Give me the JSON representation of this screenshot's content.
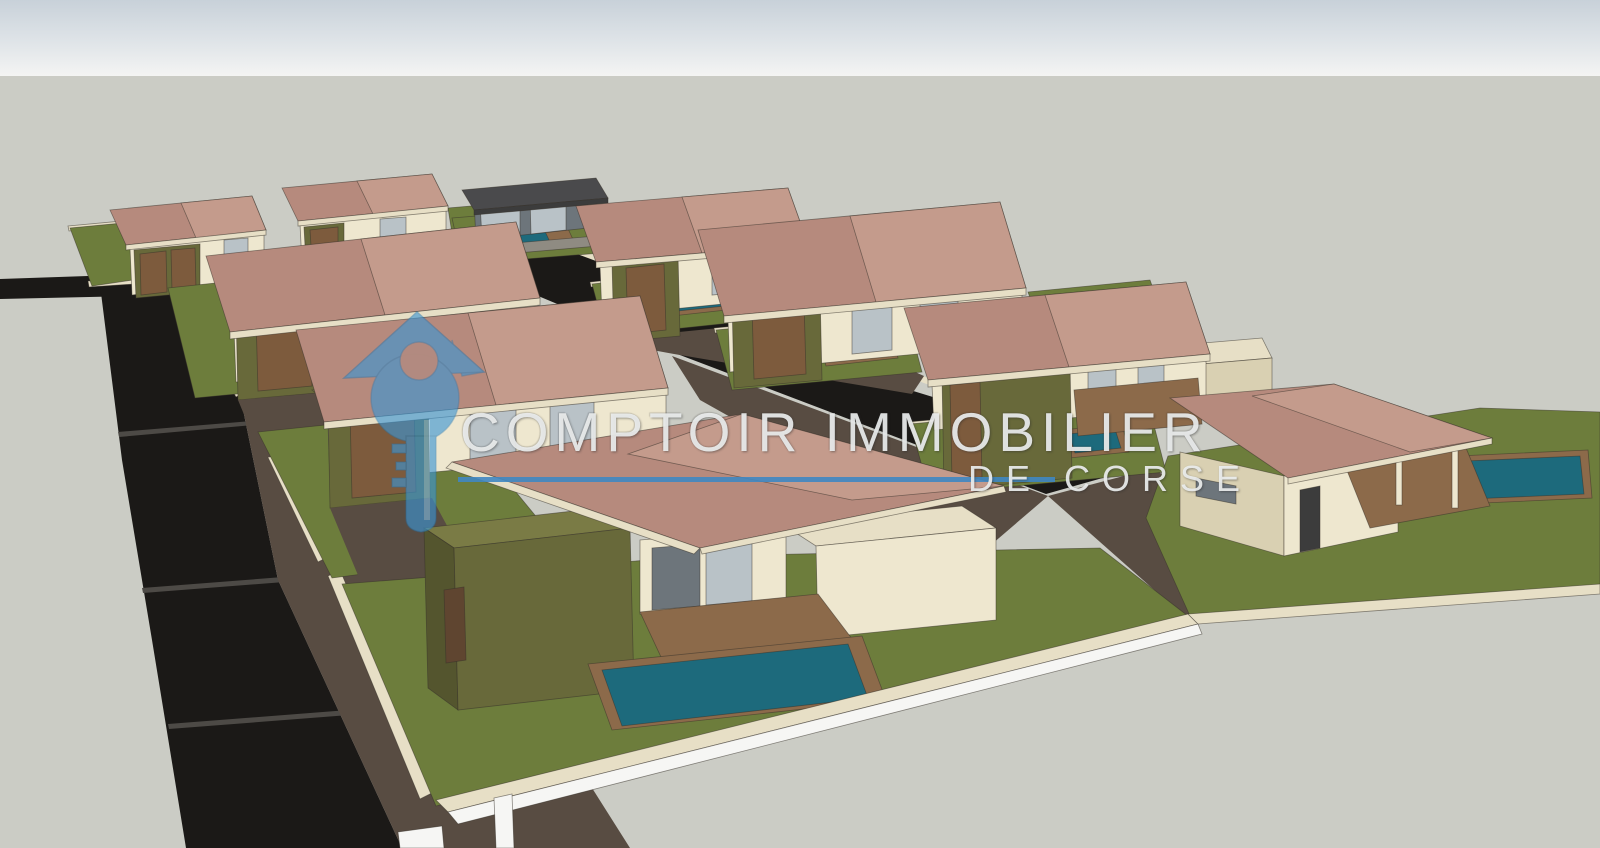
{
  "watermark": {
    "title": "COMPTOIR IMMOBILIER",
    "subtitle": "DE CORSE",
    "logo_color": "#3b96d5",
    "logo_edge_color": "#1f6fa8",
    "line_color": "#3f87c2",
    "text_color": "#e9ecec"
  },
  "palette": {
    "sky_top": "#c8d1d9",
    "sky_mid": "#dfe4e8",
    "sky_bottom": "#f4f4f3",
    "ground": "#cbccc5",
    "road": "#1b1917",
    "road_seam": "#4d4a46",
    "drive": "#584c42",
    "drive_dark": "#453c34",
    "lawn": "#6d7d3c",
    "roof": "#b68a7d",
    "roof_light": "#c49b8c",
    "dark_roof": "#4a4a4c",
    "eave": "#e7dfc6",
    "wall_light": "#eee7cf",
    "wall_mid": "#d9d0b2",
    "wall_dark": "#c4b998",
    "olive": "#68693a",
    "olive_top": "#7a7b45",
    "olive_dark": "#54552e",
    "wood": "#7d5b3d",
    "wood_dark": "#5f4530",
    "deck": "#8c6a4a",
    "pool": "#1d6a7c",
    "glass": "#b9c2c7",
    "glass_dark": "#6d757b",
    "frame": "#3c3c3c",
    "stone": "#8f8b82",
    "white": "#f6f6f4"
  },
  "scene": {
    "description": "SketchUp-style 3D render of a villa development: two rows of hip-roof villas with olive garages, lawns, pools, paved driveways and dark asphalt roads, viewed from above.",
    "polygons": [
      {
        "n": "road-stub-left",
        "f": "road",
        "s": "none",
        "p": "0,279 178,273 178,295 0,299"
      },
      {
        "n": "main-road",
        "f": "road",
        "s": "none",
        "p": "100,285 180,279 232,356 278,580 402,848 186,848 152,640 122,460"
      },
      {
        "n": "road-seam-1",
        "f": "road_seam",
        "s": "none",
        "p": "118,432 264,420 265,424 119,437"
      },
      {
        "n": "road-seam-2",
        "f": "road_seam",
        "s": "none",
        "p": "142,588 322,574 323,579 143,593"
      },
      {
        "n": "road-seam-3",
        "f": "road_seam",
        "s": "none",
        "p": "168,724 374,708 375,713 169,729"
      },
      {
        "n": "central-street",
        "f": "road",
        "s": "none",
        "p": "438,254 566,246 910,390 1152,464 1046,494 672,352"
      },
      {
        "n": "street-curb",
        "f": "eave",
        "s": "none",
        "p": "564,243 1150,460 1147,466 561,248"
      },
      {
        "n": "drive-band-left",
        "f": "drive",
        "s": "none",
        "p": "180,279 252,300 344,424 436,564 530,690 630,848 402,848 278,580 232,356"
      },
      {
        "n": "drive-patch-1",
        "f": "drive_dark",
        "s": "none",
        "p": "262,352 330,344 372,418 300,428"
      },
      {
        "n": "drive-patch-2",
        "f": "drive_dark",
        "s": "none",
        "p": "330,470 420,458 470,540 376,552"
      },
      {
        "n": "drive-street-top",
        "f": "drive",
        "s": "none",
        "p": "598,340 800,320 924,376 912,394 674,354"
      },
      {
        "n": "drive-street-bottom",
        "f": "drive",
        "s": "none",
        "p": "672,356 1048,496 978,556 700,400"
      },
      {
        "n": "drive-access-right",
        "f": "drive",
        "s": "none",
        "p": "1048,496 1154,468 1278,566 1186,618"
      },
      {
        "n": "wall-cap-1",
        "f": "eave",
        "p": "88,281 178,275 179,281 89,287"
      },
      {
        "n": "wall-cap-2",
        "f": "eave",
        "p": "172,290 180,286 246,392 236,397"
      },
      {
        "n": "wall-cap-3",
        "f": "eave",
        "p": "250,420 260,415 330,556 318,562"
      },
      {
        "n": "wall-cap-4",
        "f": "eave",
        "p": "328,576 340,570 434,792 420,799"
      },
      {
        "n": "villa1-lawn-cap",
        "f": "eave",
        "p": "68,226 240,210 241,215 69,231"
      },
      {
        "n": "villa1-lawn",
        "f": "lawn",
        "p": "70,228 240,212 254,262 92,286"
      },
      {
        "n": "villa1-driveway",
        "f": "drive",
        "s": "none",
        "p": "254,262 318,256 342,300 266,308"
      },
      {
        "n": "villa1-wall",
        "f": "wall_light",
        "p": "130,248 264,234 264,280 132,295"
      },
      {
        "n": "villa1-window",
        "f": "glass",
        "p": "224,240 248,238 248,262 224,264"
      },
      {
        "n": "villa1-garage",
        "f": "olive",
        "p": "134,250 200,244 200,292 136,298"
      },
      {
        "n": "villa1-garage-door-1",
        "f": "wood",
        "p": "140,254 166,251 167,292 141,295"
      },
      {
        "n": "villa1-garage-door-2",
        "f": "wood",
        "p": "171,250 195,248 196,289 172,291"
      },
      {
        "n": "villa1-roof",
        "f": "roof",
        "p": "110,210 252,196 266,230 126,245"
      },
      {
        "n": "villa1-roof-hip",
        "f": "roof_light",
        "p": "181,203 252,196 266,230 196,238"
      },
      {
        "n": "villa1-fascia",
        "f": "eave",
        "p": "126,245 266,230 266,235 126,250"
      },
      {
        "n": "villa2-wall",
        "f": "wall_light",
        "p": "300,224 446,210 446,250 302,264"
      },
      {
        "n": "villa2-garage",
        "f": "olive",
        "p": "304,227 344,223 344,260 306,264"
      },
      {
        "n": "villa2-garage-door",
        "f": "wood",
        "p": "310,230 338,227 338,258 312,261"
      },
      {
        "n": "villa2-window",
        "f": "glass",
        "p": "380,219 406,217 406,242 380,244"
      },
      {
        "n": "villa2-lawn",
        "f": "lawn",
        "p": "448,208 506,203 518,240 454,246"
      },
      {
        "n": "villa2-roof",
        "f": "roof",
        "p": "282,188 432,174 448,206 298,221"
      },
      {
        "n": "villa2-roof-hip",
        "f": "roof_light",
        "p": "357,181 432,174 448,206 373,214"
      },
      {
        "n": "villa2-fascia",
        "f": "eave",
        "p": "298,221 448,206 448,211 298,226"
      },
      {
        "n": "modern-house-lawn",
        "f": "lawn",
        "p": "452,218 600,206 614,252 462,264"
      },
      {
        "n": "modern-house-deck",
        "f": "deck",
        "p": "470,228 564,220 576,246 480,254"
      },
      {
        "n": "modern-house-pool",
        "f": "pool",
        "p": "488,230 542,225 550,242 494,247"
      },
      {
        "n": "modern-house-body",
        "f": "glass_dark",
        "p": "474,200 588,190 588,228 476,240"
      },
      {
        "n": "modern-house-glass-1",
        "f": "glass",
        "p": "480,203 520,200 520,234 482,238"
      },
      {
        "n": "modern-house-glass-2",
        "f": "glass",
        "p": "530,198 566,195 566,230 531,234"
      },
      {
        "n": "modern-house-flat-roof",
        "f": "dark_roof",
        "p": "462,190 596,178 608,198 474,210"
      },
      {
        "n": "modern-house-roof-edge",
        "f": "frame",
        "p": "474,210 608,198 608,203 474,215"
      },
      {
        "n": "modern-house-front-wall",
        "f": "stone",
        "p": "458,248 596,236 598,246 460,258"
      },
      {
        "n": "villa4-lawn-cap",
        "f": "eave",
        "p": "590,282 784,262 785,267 591,287"
      },
      {
        "n": "villa4-lawn",
        "f": "lawn",
        "p": "592,284 784,264 798,316 606,336"
      },
      {
        "n": "villa4-pool-deck",
        "f": "deck",
        "p": "664,290 736,282 744,308 672,316"
      },
      {
        "n": "villa4-pool",
        "f": "pool",
        "p": "672,294 728,288 734,305 678,311"
      },
      {
        "n": "villa4-wall",
        "f": "wall_light",
        "p": "600,266 804,248 804,296 602,316"
      },
      {
        "n": "villa4-window-1",
        "f": "glass",
        "p": "712,256 744,253 744,292 712,295"
      },
      {
        "n": "villa4-window-2",
        "f": "glass",
        "p": "760,252 790,250 790,288 760,291"
      },
      {
        "n": "villa4-garage-top",
        "f": "olive_top",
        "p": "598,252 664,246 678,256 612,262"
      },
      {
        "n": "villa4-garage",
        "f": "olive",
        "p": "612,262 678,256 680,336 614,342"
      },
      {
        "n": "villa4-garage-door",
        "f": "wood",
        "p": "626,268 664,264 666,330 628,334"
      },
      {
        "n": "villa4-roof",
        "f": "roof",
        "p": "576,206 788,188 808,244 596,262"
      },
      {
        "n": "villa4-roof-hip",
        "f": "roof_light",
        "p": "682,197 788,188 808,244 702,253"
      },
      {
        "n": "villa4-fascia",
        "f": "eave",
        "p": "596,262 808,244 808,250 596,268"
      },
      {
        "n": "villa5-lawn-cap",
        "f": "eave",
        "p": "714,328 906,310 907,315 715,333"
      },
      {
        "n": "villa5-lawn",
        "f": "lawn",
        "p": "716,330 906,312 922,372 732,390"
      },
      {
        "n": "villa5-pool-deck",
        "f": "deck",
        "p": "818,336 890,328 898,358 826,366"
      },
      {
        "n": "villa5-pool",
        "f": "pool",
        "p": "826,340 882,334 889,355 833,361"
      },
      {
        "n": "villa5-terrace",
        "f": "deck",
        "p": "962,344 1022,338 1036,374 976,380"
      },
      {
        "n": "villa5-wall",
        "f": "wall_light",
        "p": "728,320 1022,292 1022,344 730,372"
      },
      {
        "n": "villa5-window-1",
        "f": "glass",
        "p": "852,308 892,304 892,350 852,354"
      },
      {
        "n": "villa5-window-2",
        "f": "glass",
        "p": "920,301 958,298 958,344 920,348"
      },
      {
        "n": "villa5-garage-top",
        "f": "olive_top",
        "p": "718,288 806,280 820,291 732,299"
      },
      {
        "n": "villa5-garage",
        "f": "olive",
        "p": "732,299 820,291 822,380 734,388"
      },
      {
        "n": "villa5-garage-door",
        "f": "wood",
        "p": "752,306 804,301 806,374 754,379"
      },
      {
        "n": "villa5-roof",
        "f": "roof",
        "p": "698,230 1000,202 1026,288 724,316"
      },
      {
        "n": "villa5-roof-hip",
        "f": "roof_light",
        "p": "850,216 1000,202 1026,288 876,302"
      },
      {
        "n": "villa5-fascia",
        "f": "eave",
        "p": "724,316 1026,288 1026,295 724,323"
      },
      {
        "n": "lawn-strip-right",
        "f": "lawn",
        "p": "1028,292 1150,280 1162,314 1040,326"
      },
      {
        "n": "villa6-lawn-cap",
        "f": "eave",
        "p": "908,422 1148,400 1149,405 909,427"
      },
      {
        "n": "villa6-lawn",
        "f": "lawn",
        "p": "910,424 1148,402 1166,472 930,494"
      },
      {
        "n": "villa6-pool-deck",
        "f": "deck",
        "p": "1062,430 1122,424 1129,452 1069,458"
      },
      {
        "n": "villa6-pool",
        "f": "pool",
        "p": "1069,434 1115,429 1121,448 1075,453"
      },
      {
        "n": "villa6-backbox-top",
        "f": "eave",
        "p": "1192,344 1262,338 1272,358 1202,364"
      },
      {
        "n": "villa6-backbox",
        "f": "wall_mid",
        "p": "1202,364 1272,358 1272,394 1202,400"
      },
      {
        "n": "villa6-wall",
        "f": "wall_light",
        "p": "932,384 1206,358 1206,406 934,430"
      },
      {
        "n": "villa6-window-1",
        "f": "glass",
        "p": "1088,368 1116,366 1116,400 1088,402"
      },
      {
        "n": "villa6-window-2",
        "f": "glass",
        "p": "1138,364 1164,362 1164,396 1138,398"
      },
      {
        "n": "villa6-terrace",
        "f": "deck",
        "p": "1074,390 1198,378 1202,424 1078,436"
      },
      {
        "n": "villa6-garage-top",
        "f": "olive_top",
        "p": "928,364 1056,352 1070,363 942,375"
      },
      {
        "n": "villa6-garage",
        "f": "olive",
        "p": "942,375 1070,363 1072,478 944,490"
      },
      {
        "n": "villa6-garage-door",
        "f": "wood",
        "p": "950,385 980,382 982,477 952,480"
      },
      {
        "n": "villa6-roof",
        "f": "roof",
        "p": "904,308 1186,282 1210,354 928,380"
      },
      {
        "n": "villa6-roof-hip",
        "f": "roof_light",
        "p": "1045,295 1186,282 1210,354 1069,367"
      },
      {
        "n": "villa6-fascia",
        "f": "eave",
        "p": "928,380 1210,354 1210,361 928,387"
      },
      {
        "n": "villa7-lawn",
        "f": "lawn",
        "p": "1168,456 1480,408 1600,412 1600,586 1190,616 1146,518"
      },
      {
        "n": "villa7-pool-deck",
        "f": "deck",
        "p": "1458,456 1588,450 1592,498 1462,504"
      },
      {
        "n": "villa7-pool",
        "f": "pool",
        "p": "1466,461 1580,456 1584,494 1470,499"
      },
      {
        "n": "villa7-side-wall",
        "f": "wall_mid",
        "p": "1180,452 1284,476 1284,556 1180,526"
      },
      {
        "n": "villa7-front-wall",
        "f": "wall_light",
        "p": "1284,476 1398,452 1398,532 1284,556"
      },
      {
        "n": "villa7-door",
        "f": "frame",
        "p": "1300,490 1320,486 1320,548 1300,552"
      },
      {
        "n": "villa7-window",
        "f": "glass_dark",
        "p": "1196,478 1236,486 1236,504 1196,496"
      },
      {
        "n": "villa7-porch-deck",
        "f": "deck",
        "p": "1346,468 1466,448 1490,506 1370,528"
      },
      {
        "n": "villa7-porch-post-1",
        "f": "wall_light",
        "p": "1396,448 1402,448 1402,505 1396,505"
      },
      {
        "n": "villa7-porch-post-2",
        "f": "wall_light",
        "p": "1452,444 1458,444 1458,508 1452,508"
      },
      {
        "n": "villa7-roof",
        "f": "roof",
        "p": "1170,398 1334,384 1492,438 1288,478"
      },
      {
        "n": "villa7-roof-hip",
        "f": "roof_light",
        "p": "1252,396 1334,384 1492,438 1410,452"
      },
      {
        "n": "villa7-fascia",
        "f": "eave",
        "p": "1288,478 1492,438 1492,444 1288,484"
      },
      {
        "n": "villa8-lawn",
        "f": "lawn",
        "p": "168,288 340,270 362,382 195,398"
      },
      {
        "n": "villa8-pool-deck",
        "f": "deck",
        "p": "270,338 340,331 348,362 278,369"
      },
      {
        "n": "villa8-pool",
        "f": "pool",
        "p": "278,342 332,337 339,358 285,363"
      },
      {
        "n": "villa8-wall",
        "f": "wall_light",
        "p": "234,330 538,302 538,354 236,382"
      },
      {
        "n": "villa8-window-1",
        "f": "glass",
        "p": "356,320 398,316 398,364 356,368"
      },
      {
        "n": "villa8-window-2",
        "f": "glass",
        "p": "430,313 470,309 470,358 430,362"
      },
      {
        "n": "villa8-garage-top",
        "f": "olive_top",
        "p": "222,298 312,290 326,301 236,309"
      },
      {
        "n": "villa8-garage",
        "f": "olive",
        "p": "236,309 326,301 328,392 238,400"
      },
      {
        "n": "villa8-garage-door",
        "f": "wood",
        "p": "256,316 310,311 312,386 258,391"
      },
      {
        "n": "villa8-driveway",
        "f": "drive",
        "s": "none",
        "p": "238,400 330,392 360,448 262,458"
      },
      {
        "n": "villa8-roof",
        "f": "roof",
        "p": "206,256 516,222 540,298 230,332"
      },
      {
        "n": "villa8-roof-hip",
        "f": "roof_light",
        "p": "361,239 516,222 540,298 385,315"
      },
      {
        "n": "villa8-fascia",
        "f": "eave",
        "p": "230,332 540,298 540,305 230,339"
      },
      {
        "n": "villa9-lawn",
        "f": "lawn",
        "p": "258,432 450,412 562,548 332,578"
      },
      {
        "n": "villa9-pool-deck",
        "f": "deck",
        "p": "440,534 546,522 558,556 452,568"
      },
      {
        "n": "villa9-pool",
        "f": "pool",
        "p": "448,539 538,528 548,553 458,564"
      },
      {
        "n": "villa9-wall",
        "f": "wall_light",
        "p": "328,424 666,392 666,450 330,482"
      },
      {
        "n": "villa9-window-1",
        "f": "glass",
        "p": "470,412 516,408 516,464 470,468"
      },
      {
        "n": "villa9-window-2",
        "f": "glass",
        "p": "550,404 594,400 594,456 550,460"
      },
      {
        "n": "villa9-garage-top",
        "f": "olive_top",
        "p": "312,390 412,380 428,392 328,402"
      },
      {
        "n": "villa9-garage",
        "f": "olive",
        "p": "328,402 428,392 430,498 330,508"
      },
      {
        "n": "villa9-garage-door",
        "f": "wood",
        "p": "350,410 414,404 416,492 352,498"
      },
      {
        "n": "villa9-driveway",
        "f": "drive",
        "s": "none",
        "p": "330,508 432,498 470,568 360,580"
      },
      {
        "n": "villa9-roof",
        "f": "roof",
        "p": "296,330 640,296 668,388 324,422"
      },
      {
        "n": "villa9-roof-hip",
        "f": "roof_light",
        "p": "468,313 640,296 668,388 496,405"
      },
      {
        "n": "villa9-fascia",
        "f": "eave",
        "p": "324,422 668,388 668,395 324,429"
      },
      {
        "n": "villa10-lawn",
        "f": "lawn",
        "p": "342,584 700,556 1100,548 1188,616 436,806"
      },
      {
        "n": "villa10-front-wall",
        "f": "wall_light",
        "p": "640,540 786,528 786,600 640,614"
      },
      {
        "n": "villa10-sliding-door-1",
        "f": "glass_dark",
        "p": "652,548 700,544 700,606 652,610"
      },
      {
        "n": "villa10-sliding-door-2",
        "f": "glass",
        "p": "706,543 752,539 752,601 706,605"
      },
      {
        "n": "villa10-annex-top",
        "f": "eave",
        "p": "782,524 962,506 996,528 816,546"
      },
      {
        "n": "villa10-annex-front",
        "f": "wall_light",
        "p": "816,546 996,528 996,620 818,638"
      },
      {
        "n": "villa10-terrace",
        "f": "deck",
        "p": "640,612 818,594 862,652 668,672"
      },
      {
        "n": "villa10-garage-top",
        "f": "olive_top",
        "p": "424,528 600,508 630,528 454,548"
      },
      {
        "n": "villa10-garage-side",
        "f": "olive_dark",
        "p": "424,528 454,548 458,710 428,688"
      },
      {
        "n": "villa10-garage",
        "f": "olive",
        "p": "454,548 630,528 634,690 458,710"
      },
      {
        "n": "villa10-garage-door",
        "f": "wood_dark",
        "p": "444,590 464,587 466,660 446,663"
      },
      {
        "n": "villa10-pool-deck",
        "f": "deck",
        "p": "588,664 862,636 886,700 612,730"
      },
      {
        "n": "villa10-pool",
        "f": "pool",
        "p": "602,670 848,644 868,698 622,726"
      },
      {
        "n": "villa10-roof",
        "f": "roof",
        "p": "452,462 742,414 1004,486 700,548"
      },
      {
        "n": "villa10-roof-hip",
        "f": "roof_light",
        "p": "742,414 1004,486 852,500 628,454"
      },
      {
        "n": "villa10-fascia-left",
        "f": "eave",
        "p": "446,468 452,462 700,548 694,554"
      },
      {
        "n": "villa10-fascia-bottom",
        "f": "eave",
        "p": "700,548 1004,486 1006,492 702,554"
      },
      {
        "n": "perimeter-wall-cap-left",
        "f": "eave",
        "p": "436,800 1188,614 1198,624 448,812"
      },
      {
        "n": "perimeter-wall-face-left",
        "f": "white",
        "p": "448,812 1198,624 1202,634 458,824"
      },
      {
        "n": "perimeter-wall-cap-right",
        "f": "eave",
        "p": "1188,614 1600,584 1600,594 1198,624"
      },
      {
        "n": "white-wall-piece-1",
        "f": "white",
        "p": "494,798 512,794 514,848 496,848"
      },
      {
        "n": "white-wall-piece-2",
        "f": "white",
        "p": "398,832 442,826 444,848 400,848"
      }
    ]
  }
}
